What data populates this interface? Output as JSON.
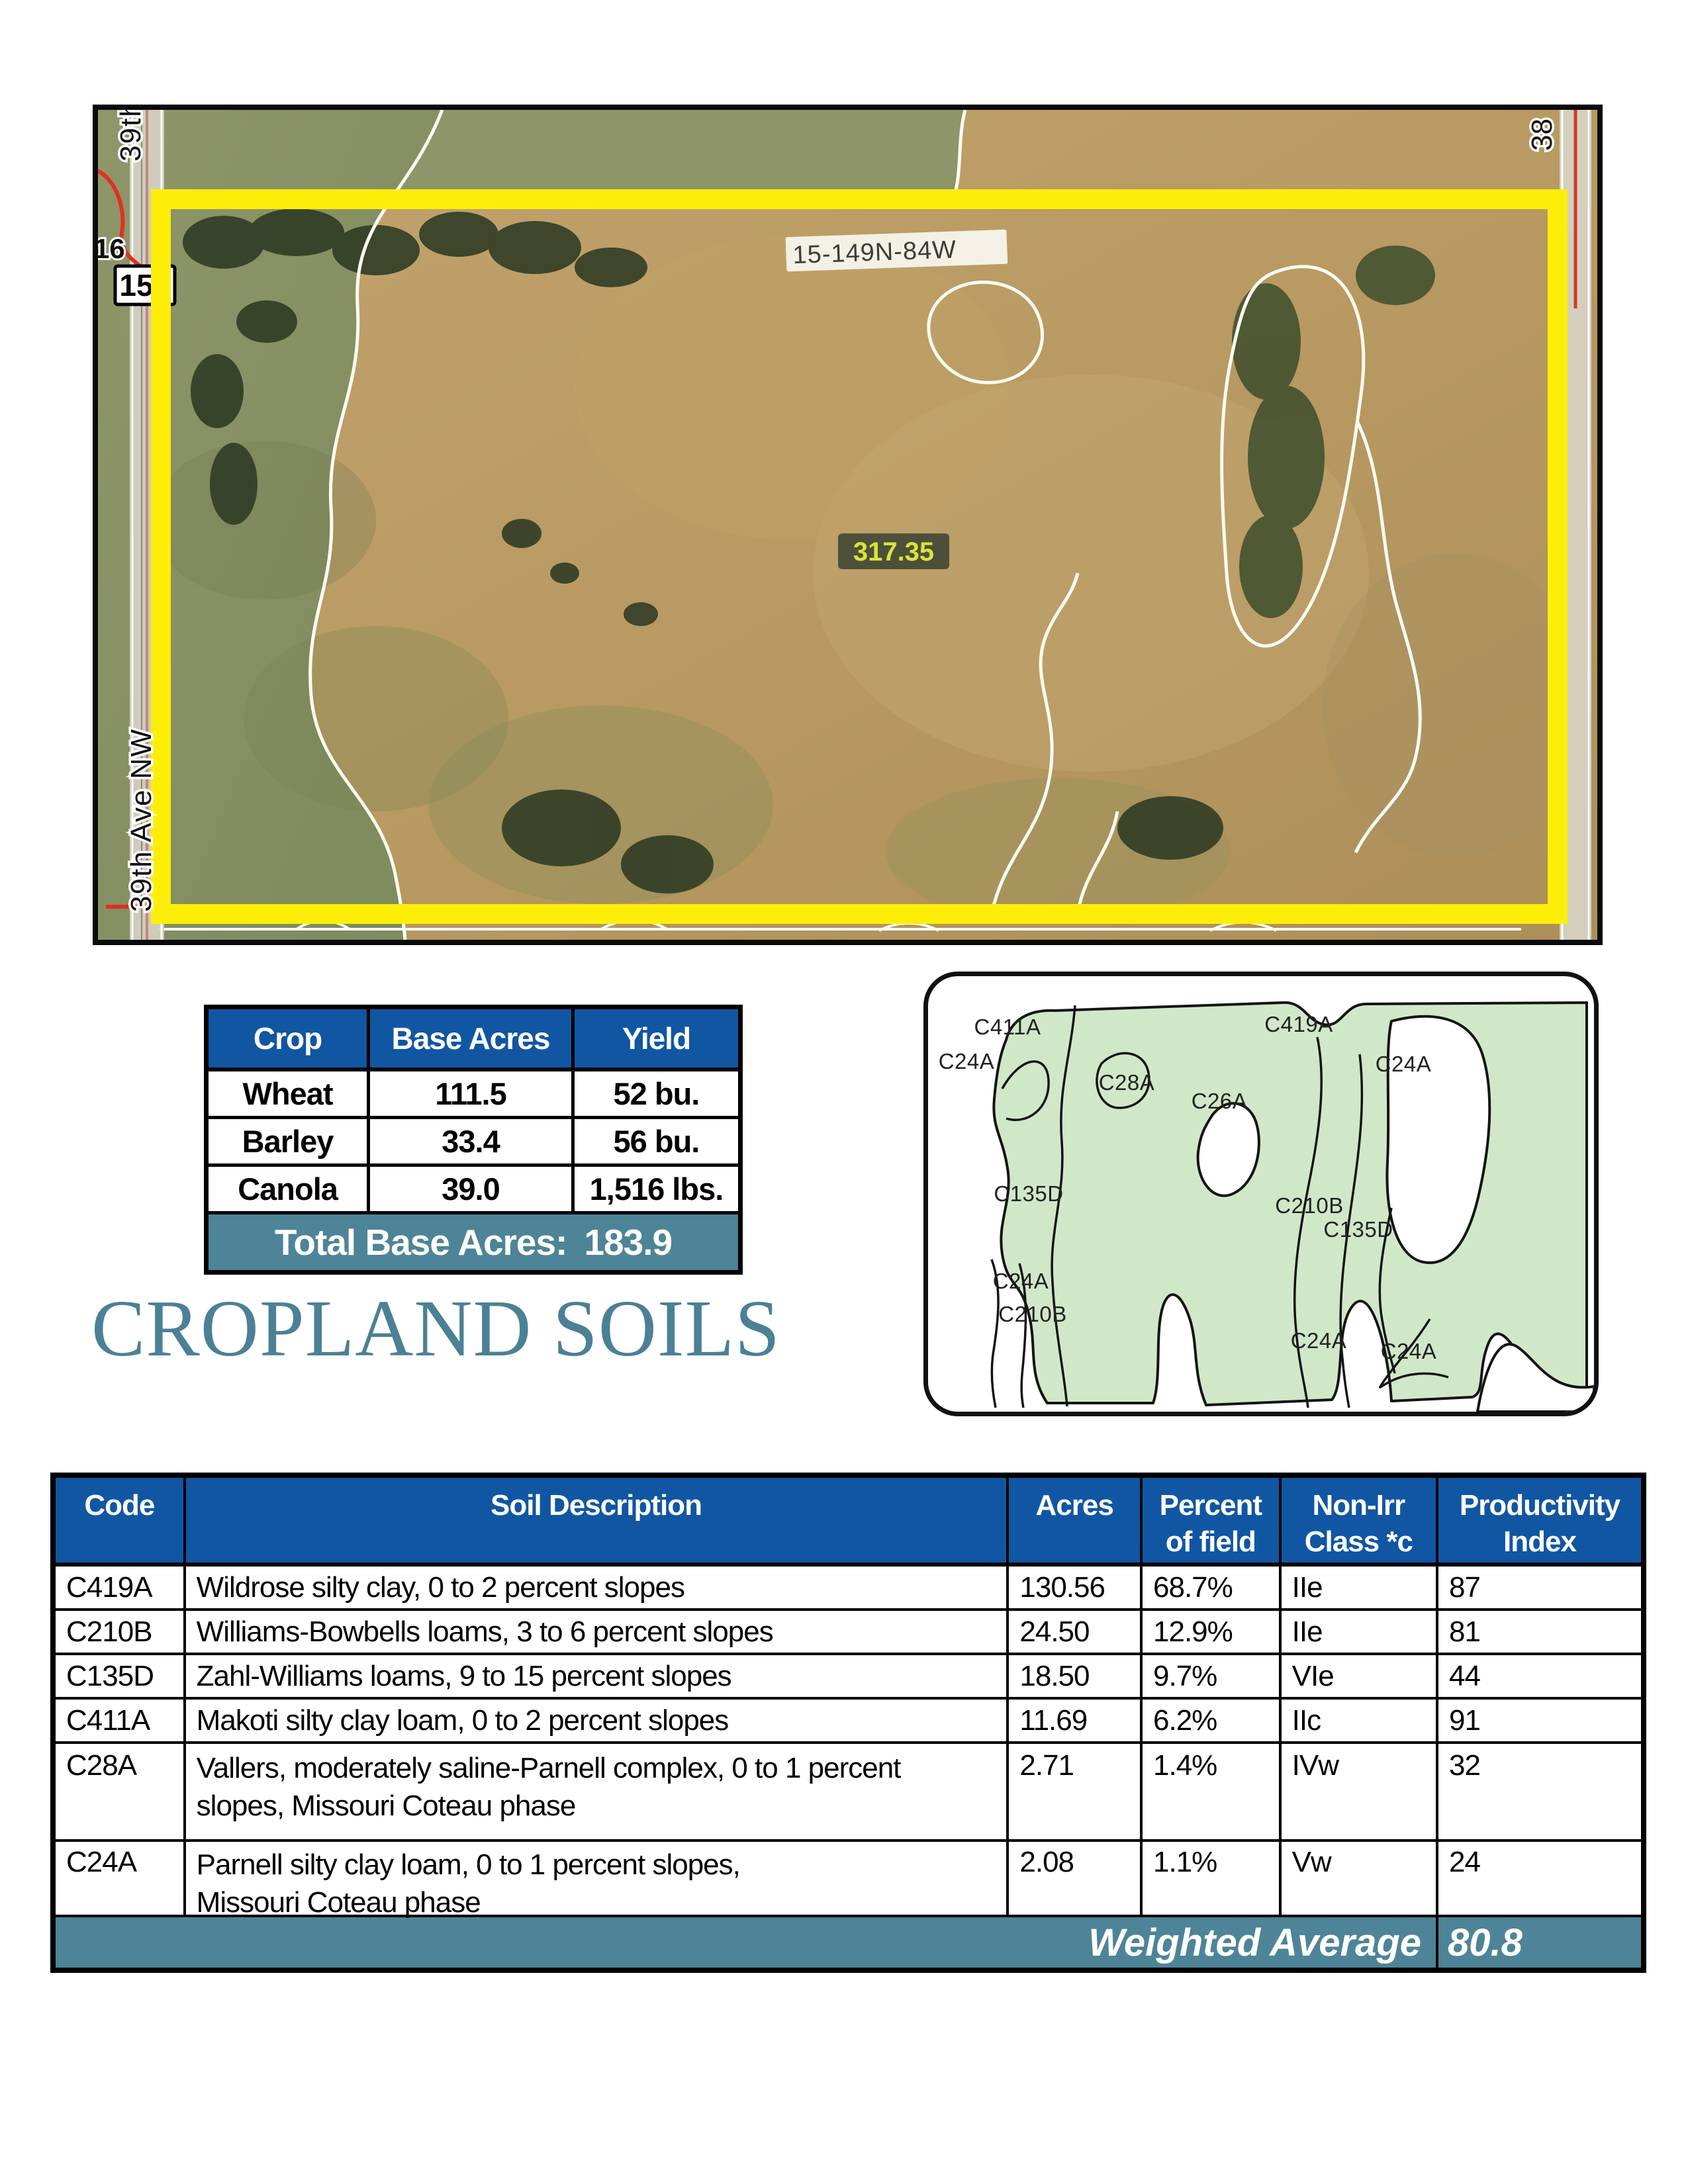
{
  "map": {
    "township_label": "15-149N-84W",
    "acres_label": "317.35",
    "road_left_label": "39th Ave NW",
    "road_top_left_label": "39th",
    "road_top_right_label": "38",
    "highway_shield_label": "15",
    "road_number_label": "16",
    "boundary_color": "#fdee0a"
  },
  "crop_table": {
    "headers": [
      "Crop",
      "Base Acres",
      "Yield"
    ],
    "rows": [
      {
        "crop": "Wheat",
        "base_acres": "111.5",
        "yield": "52 bu."
      },
      {
        "crop": "Barley",
        "base_acres": "33.4",
        "yield": "56 bu."
      },
      {
        "crop": "Canola",
        "base_acres": "39.0",
        "yield": "1,516 lbs."
      }
    ],
    "total_label": "Total Base Acres:",
    "total_value": "183.9",
    "header_bg": "#1156a3",
    "total_bg": "#4e8497"
  },
  "title": "CROPLAND SOILS",
  "title_color": "#4b8096",
  "soil_map": {
    "labels": [
      "C411A",
      "C24A",
      "C28A",
      "C419A",
      "C26A",
      "C24A",
      "C135D",
      "C210B",
      "C135D",
      "C24A",
      "C210B",
      "C24A",
      "C24A"
    ]
  },
  "soils_table": {
    "columns": [
      {
        "line1": "Code",
        "line2": ""
      },
      {
        "line1": "Soil Description",
        "line2": ""
      },
      {
        "line1": "Acres",
        "line2": ""
      },
      {
        "line1": "Percent",
        "line2": "of field"
      },
      {
        "line1": "Non-Irr",
        "line2": "Class *c"
      },
      {
        "line1": "Productivity",
        "line2": "Index"
      }
    ],
    "rows": [
      {
        "code": "C419A",
        "description": "Wildrose silty clay, 0 to 2 percent slopes",
        "acres": "130.56",
        "percent": "68.7%",
        "class": "IIe",
        "index": "87"
      },
      {
        "code": "C210B",
        "description": "Williams-Bowbells loams, 3 to 6 percent slopes",
        "acres": "24.50",
        "percent": "12.9%",
        "class": "IIe",
        "index": "81"
      },
      {
        "code": "C135D",
        "description": "Zahl-Williams loams, 9 to 15 percent slopes",
        "acres": "18.50",
        "percent": "9.7%",
        "class": "VIe",
        "index": "44"
      },
      {
        "code": "C411A",
        "description": "Makoti silty clay loam, 0 to 2 percent slopes",
        "acres": "11.69",
        "percent": "6.2%",
        "class": "IIc",
        "index": "91"
      },
      {
        "code": "C28A",
        "description": "Vallers, moderately saline-Parnell complex, 0 to 1 percent\nslopes, Missouri Coteau phase",
        "acres": "2.71",
        "percent": "1.4%",
        "class": "IVw",
        "index": "32"
      },
      {
        "code": "C24A",
        "description": "Parnell silty clay loam, 0 to 1 percent slopes,\nMissouri Coteau phase",
        "acres": "2.08",
        "percent": "1.1%",
        "class": "Vw",
        "index": "24"
      }
    ],
    "weighted_label": "Weighted Average",
    "weighted_value": "80.8"
  }
}
